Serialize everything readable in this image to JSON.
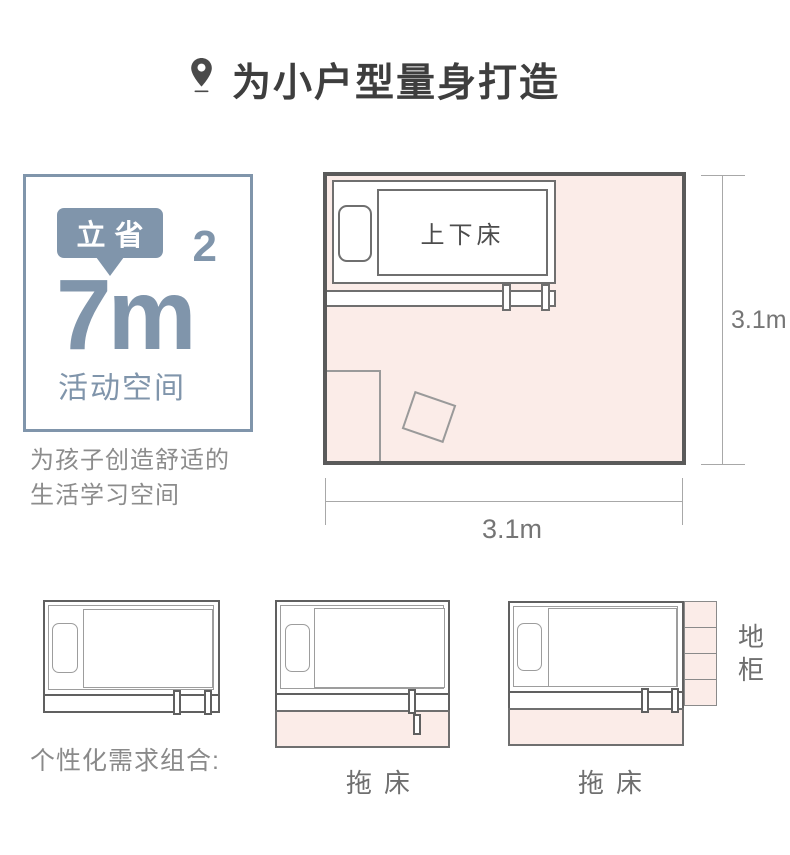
{
  "header": {
    "pin_icon": "location-pin",
    "title": "为小户型量身打造"
  },
  "savings_panel": {
    "badge_label": "立省",
    "area_value": "7",
    "area_unit": "m",
    "area_exponent": "2",
    "caption": "活动空间",
    "accent_color": "#8095ab"
  },
  "description": {
    "line1": "为孩子创造舒适的",
    "line2": "生活学习空间"
  },
  "floor_plan": {
    "bed_label": "上下床",
    "dim_right": "3.1m",
    "dim_bottom": "3.1m",
    "room_fill_color": "#fbece8",
    "wall_color": "#5a5a5a"
  },
  "options": {
    "heading": "个性化需求组合:",
    "diagram1": {
      "name": "bunk-bed"
    },
    "diagram2": {
      "name": "bunk-bed-with-trundle",
      "label": "拖床"
    },
    "diagram3": {
      "name": "bunk-bed-with-trundle-and-cabinet",
      "label": "拖床",
      "side_label": "地柜"
    }
  }
}
